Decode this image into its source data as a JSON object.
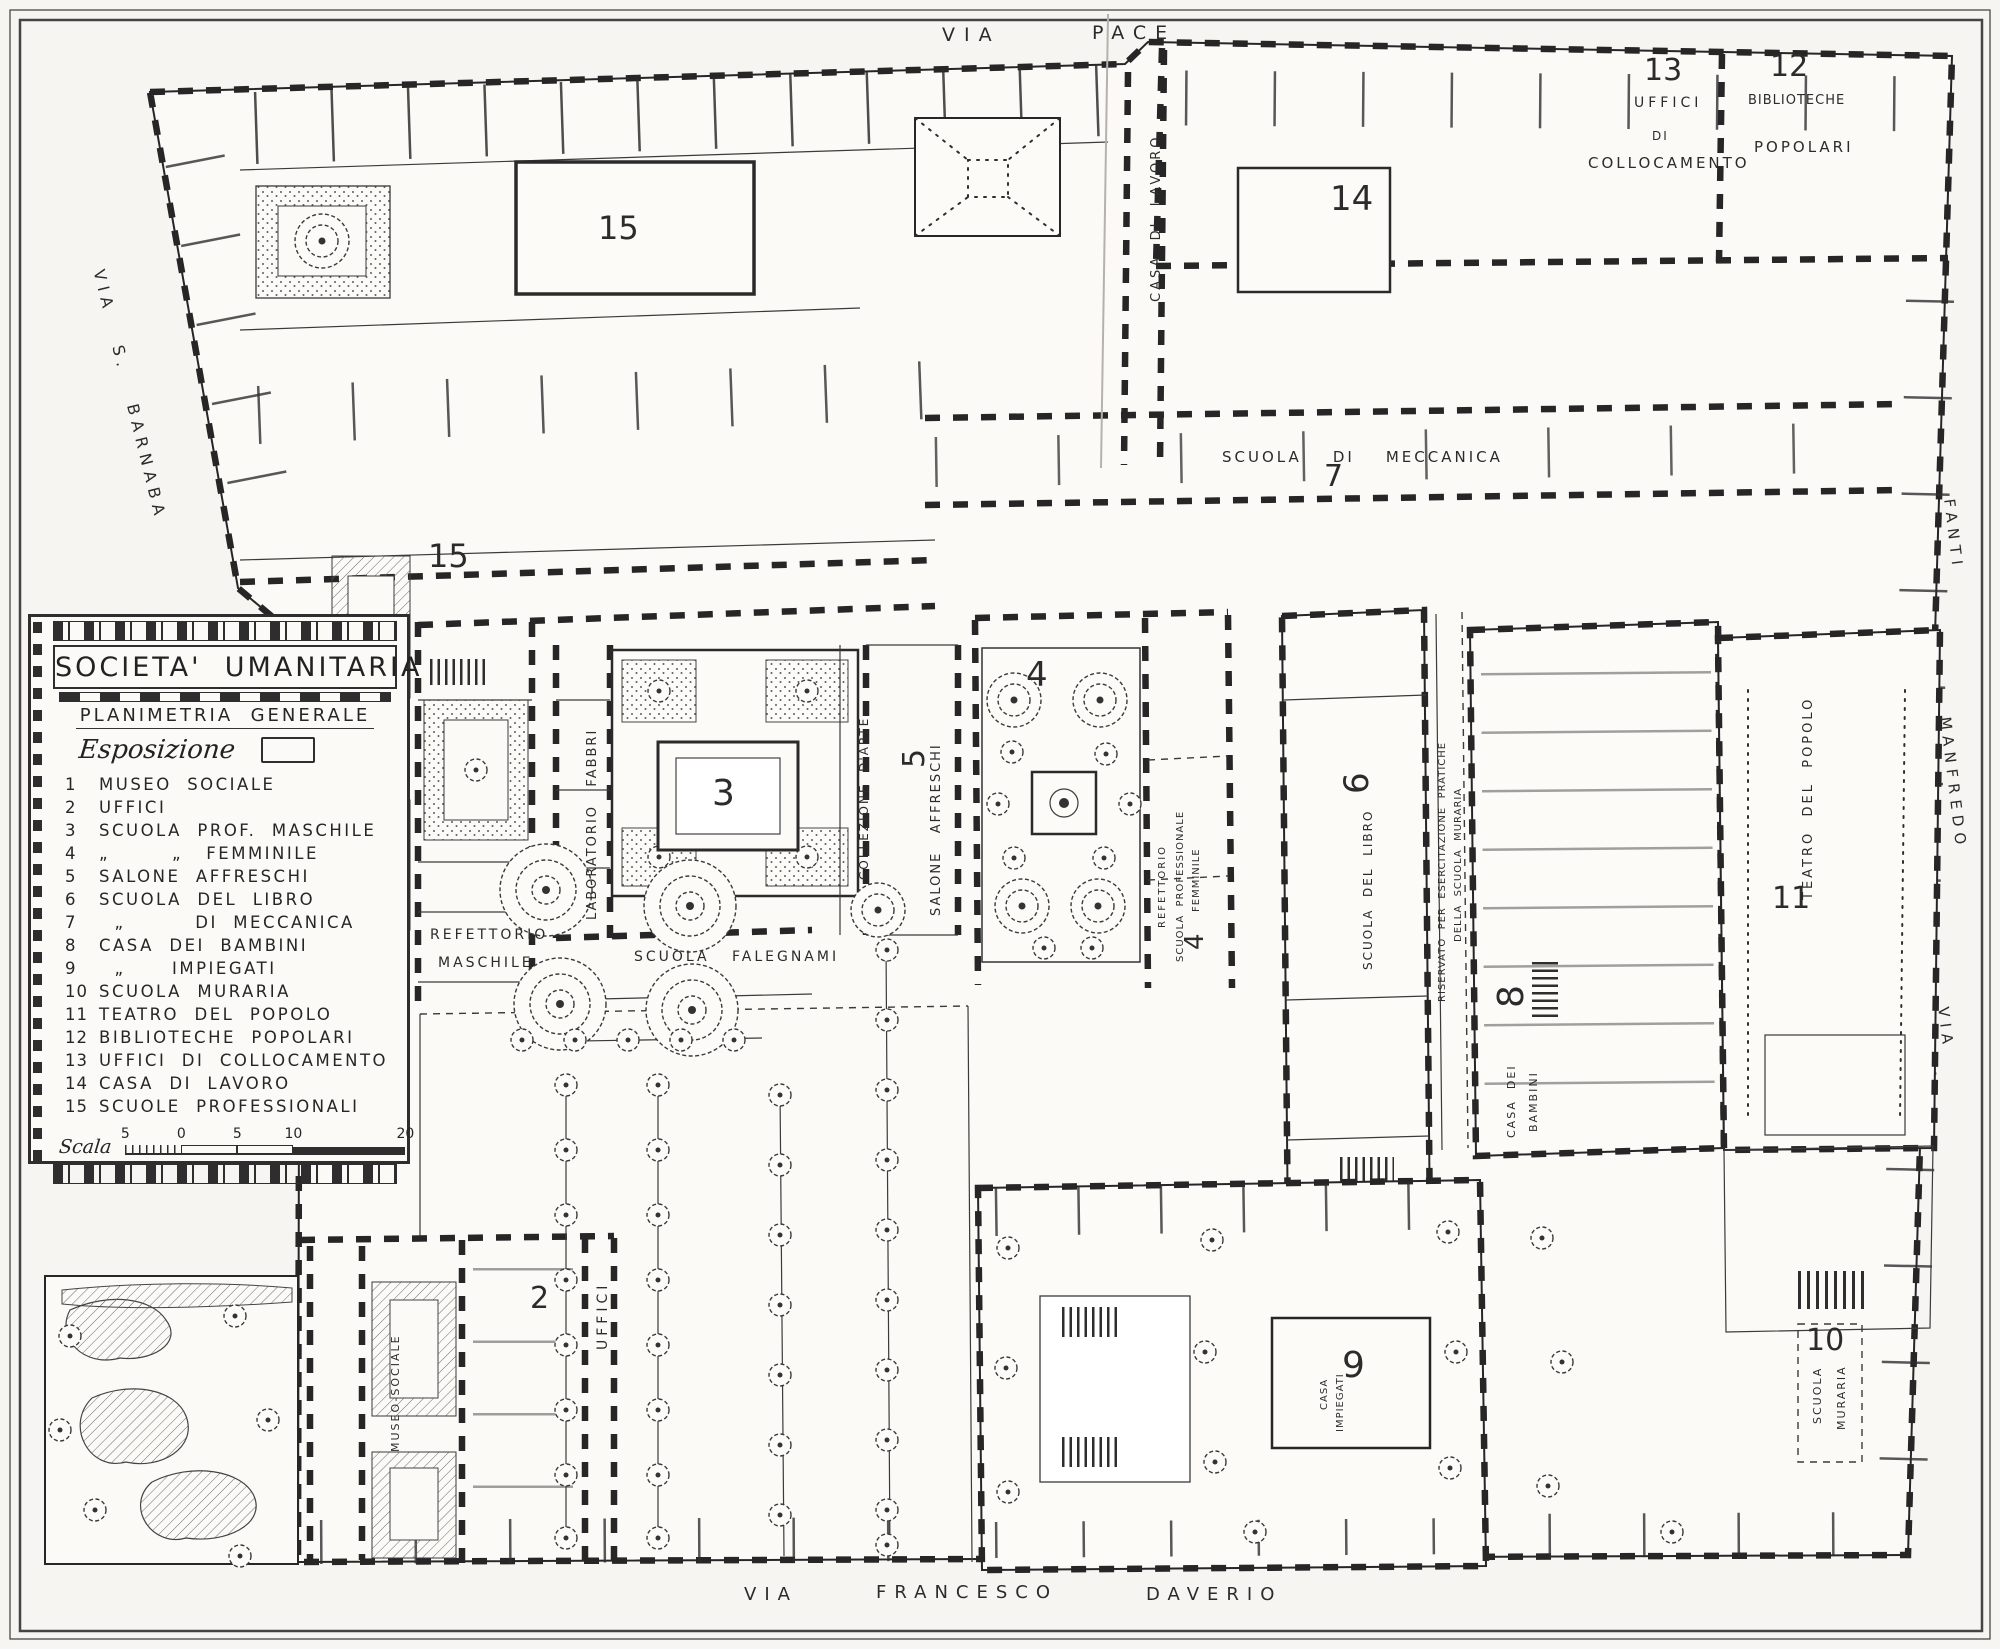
{
  "legend": {
    "title": "SOCIETA'  UMANITARIA",
    "subtitle": "PLANIMETRIA  GENERALE",
    "exposition_label": "Esposizione",
    "items": [
      {
        "num": "1",
        "label": "MUSEO  SOCIALE"
      },
      {
        "num": "2",
        "label": "UFFICI"
      },
      {
        "num": "3",
        "label": "SCUOLA  PROF.  MASCHILE"
      },
      {
        "num": "4",
        "label": "„        „   FEMMINILE"
      },
      {
        "num": "5",
        "label": "SALONE  AFFRESCHI"
      },
      {
        "num": "6",
        "label": "SCUOLA  DEL  LIBRO"
      },
      {
        "num": "7",
        "label": "  „         DI  MECCANICA"
      },
      {
        "num": "8",
        "label": "CASA  DEI  BAMBINI"
      },
      {
        "num": "9",
        "label": "  „      IMPIEGATI"
      },
      {
        "num": "10",
        "label": "SCUOLA  MURARIA"
      },
      {
        "num": "11",
        "label": "TEATRO  DEL  POPOLO"
      },
      {
        "num": "12",
        "label": "BIBLIOTECHE  POPOLARI"
      },
      {
        "num": "13",
        "label": "UFFICI  DI  COLLOCAMENTO"
      },
      {
        "num": "14",
        "label": "CASA  DI  LAVORO"
      },
      {
        "num": "15",
        "label": "SCUOLE  PROFESSIONALI"
      }
    ],
    "scale": {
      "label": "Scala",
      "ticks": [
        "5",
        "0",
        "5",
        "10",
        "20"
      ]
    }
  },
  "plan_labels": [
    {
      "id": "street-via-pace-word-1",
      "text": "VIA",
      "x": 942,
      "y": 26,
      "size": 19,
      "ls": 9
    },
    {
      "id": "street-via-pace-word-2",
      "text": "PACE",
      "x": 1092,
      "y": 24,
      "size": 19,
      "ls": 9
    },
    {
      "id": "street-via-s-barnaba",
      "text": "VIA   S.   BARNABA",
      "x": 106,
      "y": 268,
      "rot": 76,
      "size": 16,
      "ls": 6
    },
    {
      "id": "street-fanti",
      "text": "FANTI",
      "x": 1956,
      "y": 498,
      "rot": 83,
      "size": 15,
      "ls": 6
    },
    {
      "id": "street-manfredo",
      "text": "MANFREDO",
      "x": 1952,
      "y": 716,
      "rot": 83,
      "size": 15,
      "ls": 6
    },
    {
      "id": "street-via-east",
      "text": "VIA",
      "x": 1950,
      "y": 1006,
      "rot": 83,
      "size": 15,
      "ls": 6
    },
    {
      "id": "street-via-daverio-word-1",
      "text": "VIA",
      "x": 744,
      "y": 1586,
      "size": 18,
      "ls": 8
    },
    {
      "id": "street-via-daverio-word-2",
      "text": "FRANCESCO",
      "x": 876,
      "y": 1584,
      "size": 18,
      "ls": 8
    },
    {
      "id": "street-via-daverio-word-3",
      "text": "DAVERIO",
      "x": 1146,
      "y": 1586,
      "size": 18,
      "ls": 8
    },
    {
      "id": "label-15-hall",
      "text": "15",
      "x": 598,
      "y": 212,
      "size": 32
    },
    {
      "id": "label-15-west",
      "text": "15",
      "x": 428,
      "y": 540,
      "size": 32
    },
    {
      "id": "label-14",
      "text": "14",
      "x": 1330,
      "y": 182,
      "size": 34
    },
    {
      "id": "label-13",
      "text": "13",
      "x": 1644,
      "y": 56,
      "size": 30
    },
    {
      "id": "label-uffici-collocamento-1",
      "text": "UFFICI",
      "x": 1634,
      "y": 96,
      "size": 14,
      "ls": 4
    },
    {
      "id": "label-uffici-collocamento-2",
      "text": "DI",
      "x": 1652,
      "y": 130,
      "size": 12,
      "ls": 2
    },
    {
      "id": "label-uffici-collocamento-3",
      "text": "COLLOCAMENTO",
      "x": 1588,
      "y": 156,
      "size": 15,
      "ls": 3
    },
    {
      "id": "label-12",
      "text": "12",
      "x": 1770,
      "y": 52,
      "size": 30
    },
    {
      "id": "label-biblioteche-popolari-1",
      "text": "BIBLIOTECHE",
      "x": 1748,
      "y": 94,
      "size": 13,
      "ls": 1
    },
    {
      "id": "label-biblioteche-popolari-2",
      "text": "POPOLARI",
      "x": 1754,
      "y": 140,
      "size": 15,
      "ls": 3
    },
    {
      "id": "label-casa-di-lavoro",
      "text": "CASA  DI  LAVORO",
      "x": 1150,
      "y": 302,
      "rot": -90,
      "size": 13,
      "ls": 3
    },
    {
      "id": "label-scuola-di-meccanica",
      "text": "SCUOLA    DI    MECCANICA",
      "x": 1222,
      "y": 450,
      "size": 15,
      "ls": 3
    },
    {
      "id": "label-7",
      "text": "7",
      "x": 1324,
      "y": 462,
      "size": 30
    },
    {
      "id": "label-3",
      "text": "3",
      "x": 712,
      "y": 776,
      "size": 36
    },
    {
      "id": "label-5",
      "text": "5",
      "x": 900,
      "y": 768,
      "rot": -90,
      "size": 30
    },
    {
      "id": "label-salone-affreschi",
      "text": "SALONE   AFFRESCHI",
      "x": 930,
      "y": 916,
      "rot": -90,
      "size": 13,
      "ls": 2
    },
    {
      "id": "label-collezione-d-arte",
      "text": "COLLEZIONE  D'ARTE",
      "x": 858,
      "y": 880,
      "rot": -90,
      "size": 12,
      "ls": 2
    },
    {
      "id": "label-laboratorio-fabbri",
      "text": "LABORATORIO   FABBRI",
      "x": 586,
      "y": 920,
      "rot": -90,
      "size": 13,
      "ls": 2
    },
    {
      "id": "label-refettorio-maschile-1",
      "text": "REFETTORIO",
      "x": 430,
      "y": 928,
      "size": 14,
      "ls": 3
    },
    {
      "id": "label-refettorio-maschile-2",
      "text": "MASCHILE",
      "x": 438,
      "y": 956,
      "size": 14,
      "ls": 3
    },
    {
      "id": "label-scuola-falegnami",
      "text": "SCUOLA   FALEGNAMI",
      "x": 634,
      "y": 950,
      "size": 14,
      "ls": 3
    },
    {
      "id": "label-4-garden",
      "text": "4",
      "x": 1026,
      "y": 658,
      "size": 34
    },
    {
      "id": "label-refettorio-femminile",
      "text": "REFETTORIO",
      "x": 1158,
      "y": 928,
      "rot": -90,
      "size": 10,
      "ls": 2
    },
    {
      "id": "label-scuola-prof-femminile-1",
      "text": "SCUOLA  PROFESSIONALE",
      "x": 1176,
      "y": 962,
      "rot": -90,
      "size": 10,
      "ls": 1
    },
    {
      "id": "label-scuola-prof-femminile-2",
      "text": "FEMMINILE",
      "x": 1192,
      "y": 912,
      "rot": -90,
      "size": 10,
      "ls": 1
    },
    {
      "id": "label-4-wing",
      "text": "4",
      "x": 1182,
      "y": 950,
      "rot": -90,
      "size": 26
    },
    {
      "id": "label-6",
      "text": "6",
      "x": 1340,
      "y": 794,
      "rot": -90,
      "size": 34
    },
    {
      "id": "label-scuola-del-libro",
      "text": "SCUOLA  DEL  LIBRO",
      "x": 1362,
      "y": 970,
      "rot": -90,
      "size": 12,
      "ls": 2
    },
    {
      "id": "label-riservato-1",
      "text": "RISERVATO  PER  ESERCITAZIONE  PRATICHE",
      "x": 1438,
      "y": 1002,
      "rot": -90,
      "size": 10,
      "ls": 1
    },
    {
      "id": "label-riservato-2",
      "text": "DELLA  SCUOLA  MURARIA",
      "x": 1454,
      "y": 942,
      "rot": -90,
      "size": 10,
      "ls": 1
    },
    {
      "id": "label-8",
      "text": "8",
      "x": 1494,
      "y": 1008,
      "rot": -90,
      "size": 36
    },
    {
      "id": "label-casa-dei-bambini-1",
      "text": "CASA  DEI",
      "x": 1506,
      "y": 1138,
      "rot": -90,
      "size": 11,
      "ls": 2
    },
    {
      "id": "label-casa-dei-bambini-2",
      "text": "BAMBINI",
      "x": 1528,
      "y": 1132,
      "rot": -90,
      "size": 11,
      "ls": 2
    },
    {
      "id": "label-11",
      "text": "11",
      "x": 1772,
      "y": 884,
      "size": 30
    },
    {
      "id": "label-teatro-del-popolo",
      "text": "TEATRO  DEL  POPOLO",
      "x": 1802,
      "y": 900,
      "rot": -90,
      "size": 13,
      "ls": 3
    },
    {
      "id": "label-9",
      "text": "9",
      "x": 1342,
      "y": 1348,
      "size": 36
    },
    {
      "id": "label-casa-impiegati-1",
      "text": "CASA",
      "x": 1320,
      "y": 1410,
      "rot": -90,
      "size": 10,
      "ls": 1
    },
    {
      "id": "label-casa-impiegati-2",
      "text": "IMPIEGATI",
      "x": 1336,
      "y": 1432,
      "rot": -90,
      "size": 10,
      "ls": 1
    },
    {
      "id": "label-10",
      "text": "10",
      "x": 1806,
      "y": 1326,
      "size": 30
    },
    {
      "id": "label-scuola-muraria-1",
      "text": "SCUOLA",
      "x": 1812,
      "y": 1424,
      "rot": -90,
      "size": 11,
      "ls": 2
    },
    {
      "id": "label-scuola-muraria-2",
      "text": "MURARIA",
      "x": 1836,
      "y": 1430,
      "rot": -90,
      "size": 11,
      "ls": 2
    },
    {
      "id": "label-2",
      "text": "2",
      "x": 530,
      "y": 1284,
      "size": 30
    },
    {
      "id": "label-uffici-west",
      "text": "UFFICI",
      "x": 596,
      "y": 1350,
      "rot": -90,
      "size": 14,
      "ls": 4
    },
    {
      "id": "label-museo-sociale",
      "text": "MUSEO-SOCIALE",
      "x": 390,
      "y": 1452,
      "rot": -90,
      "size": 11,
      "ls": 2
    }
  ]
}
